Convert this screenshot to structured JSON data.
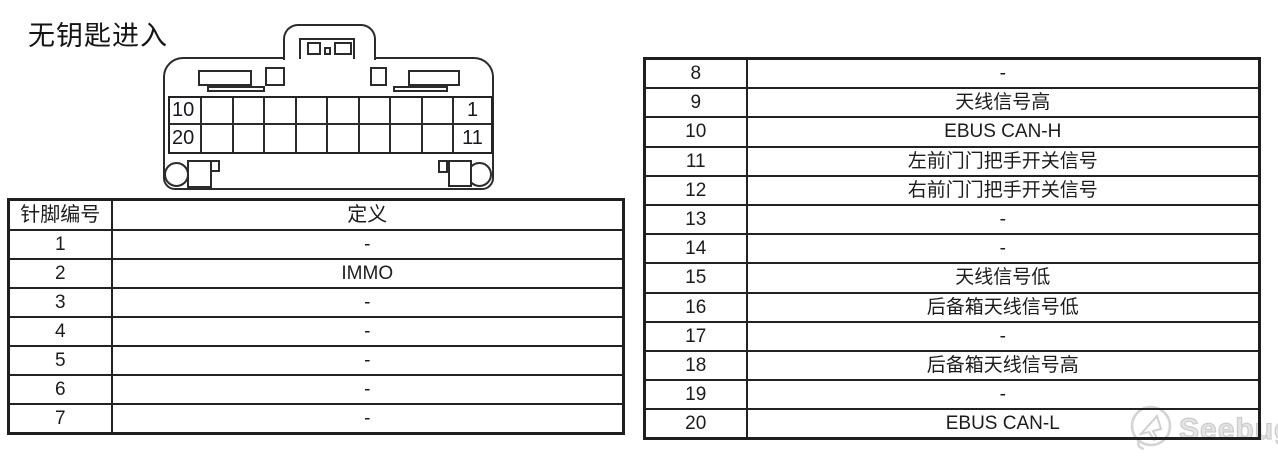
{
  "title": "无钥匙进入",
  "connector": {
    "rows": 2,
    "columns": 10,
    "pin_labels": {
      "top_left": "10",
      "top_right": "1",
      "bottom_left": "20",
      "bottom_right": "11"
    }
  },
  "pin_table": {
    "headers": [
      "针脚编号",
      "定义"
    ],
    "left_rows": [
      [
        "1",
        "-"
      ],
      [
        "2",
        "IMMO"
      ],
      [
        "3",
        "-"
      ],
      [
        "4",
        "-"
      ],
      [
        "5",
        "-"
      ],
      [
        "6",
        "-"
      ],
      [
        "7",
        "-"
      ]
    ],
    "right_rows": [
      [
        "8",
        "-"
      ],
      [
        "9",
        "天线信号高"
      ],
      [
        "10",
        "EBUS CAN-H"
      ],
      [
        "11",
        "左前门门把手开关信号"
      ],
      [
        "12",
        "右前门门把手开关信号"
      ],
      [
        "13",
        "-"
      ],
      [
        "14",
        "-"
      ],
      [
        "15",
        "天线信号低"
      ],
      [
        "16",
        "后备箱天线信号低"
      ],
      [
        "17",
        "-"
      ],
      [
        "18",
        "后备箱天线信号高"
      ],
      [
        "19",
        "-"
      ],
      [
        "20",
        "EBUS CAN-L"
      ]
    ]
  },
  "watermark": {
    "label": "Seebug",
    "icon": "seebug-pointer-icon"
  },
  "colors": {
    "line": "#2b2b2b",
    "text": "#1c1c1c",
    "table_border": "#1f1f1f",
    "watermark": "#d4d4d4",
    "background": "#ffffff"
  }
}
